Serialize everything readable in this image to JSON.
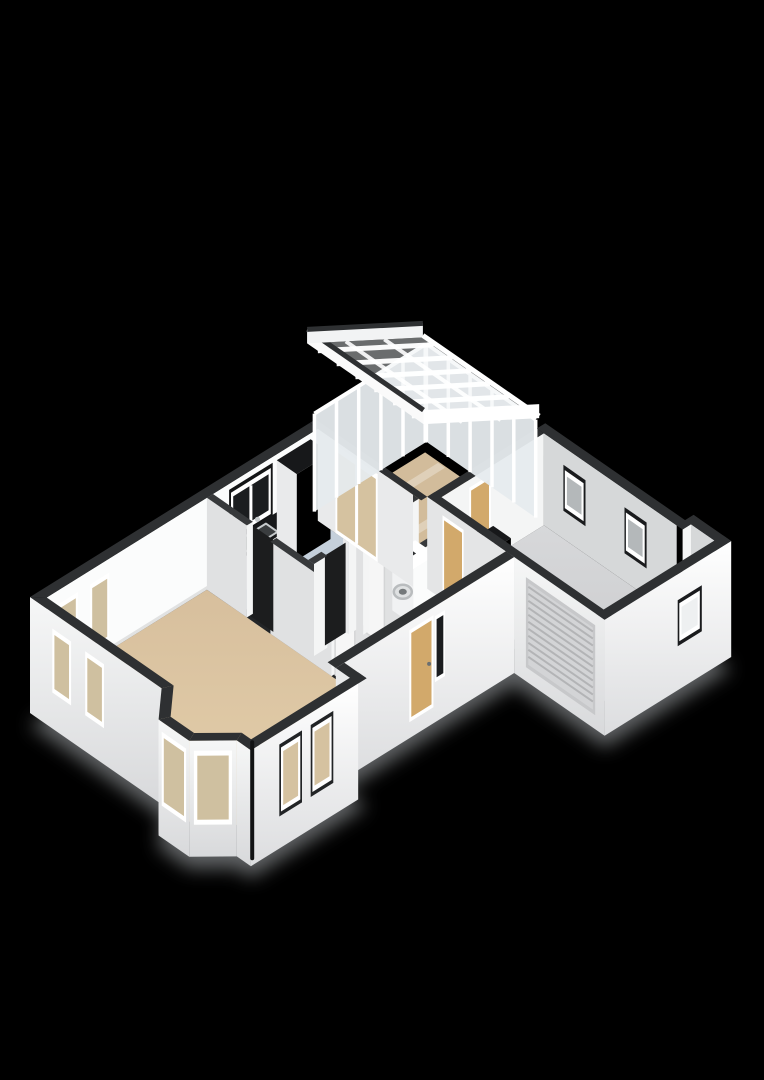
{
  "scene": {
    "label": "3d-floorplan-ground-floor",
    "width": 764,
    "height": 1080,
    "background": "#000000"
  },
  "rooms": [
    {
      "id": "living-room",
      "floor_material": "tan"
    },
    {
      "id": "kitchen",
      "floor_material": "blue-gray"
    },
    {
      "id": "conservatory",
      "floor_material": "tan",
      "roof": "glass-with-white-rafters"
    },
    {
      "id": "hallway",
      "floor_material": "light-gray"
    },
    {
      "id": "utility-room",
      "floor_material": "blue-gray"
    },
    {
      "id": "toilet",
      "floor_material": "white"
    },
    {
      "id": "garage",
      "floor_material": "gray"
    }
  ],
  "features": [
    "bay-window",
    "living-nw-windows",
    "living-se-windows",
    "kitchen-window",
    "kitchen-counter-sink",
    "kitchen-tall-cabinet",
    "french-doors-to-conservatory",
    "glass-roof-rafters",
    "front-door",
    "front-door-sidelight",
    "interior-door-leaf",
    "washing-machine",
    "toilet-fixture",
    "garage-roller-door",
    "garage-ne-windows",
    "garage-se-window",
    "garage-side-door",
    "garage-kitchenette",
    "rain-downpipe",
    "drop-shadow"
  ],
  "palette": {
    "background": "#000000",
    "capOuter": "#2e3032",
    "capInner": "#37393b",
    "wallWhite": "#fbfcfc",
    "wallLight": "#f4f5f5",
    "wallMid": "#e9eaeb",
    "wallShade": "#e0e1e2",
    "wallGray": "#d7d8d9",
    "floorLiving": "#d7bf9d",
    "floorLivingLight": "#e4cfab",
    "floorConservatory": "#d2bc9b",
    "floorKitchen": "#c5d0db",
    "floorHall": "#d8d9db",
    "floorToilet": "#e8e9ea",
    "floorGarage": "#c9cacc",
    "floorGarageLight": "#d7d8da",
    "glassPale": "#dfe6ea",
    "glassDark": "#1b1d1f",
    "glassWarm": "#cfc0a0",
    "glassTan": "#d5c2a0",
    "glassGray": "#b4b8ba",
    "glassConservatory": "#e6ebee",
    "roofGlass": "rgba(234,239,242,0.45)",
    "frame": "#ffffff",
    "doorTan": "#d2a96b",
    "roller": "#d3d4d6",
    "rollerLine": "#b3b4b6",
    "counterTop": "#17181a",
    "steel": "#c6cacc",
    "basin": "#3a3d3f",
    "threshold": "#232527",
    "shadow": "#c2c6c9",
    "pipe": "#121314",
    "doorLeaf": "#f6f6f6"
  }
}
